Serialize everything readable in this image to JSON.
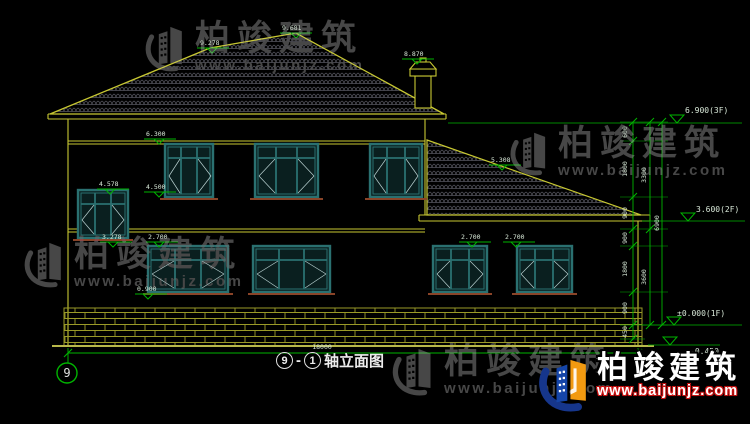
{
  "brand": {
    "name": "柏竣建筑",
    "url": "www.baijunjz.com"
  },
  "title_block": {
    "axis_left": "9",
    "separator": "-",
    "axis_right": "1",
    "name": "轴立面图"
  },
  "axis_bubbles": {
    "left": "9"
  },
  "dimensions": {
    "overall_width": "18000",
    "right_chain": [
      "600",
      "1800",
      "900",
      "900",
      "1800",
      "900",
      "450"
    ],
    "right_groups": [
      "3300",
      "3600"
    ],
    "right_total": "6900"
  },
  "level_marks": {
    "ridge_left": "9.278",
    "ridge_peak": "9.681",
    "chimney": "8.870",
    "win2_head": "6.300",
    "annex_ridge": "5.308",
    "stair_head": "4.578",
    "win2_sill": "4.500",
    "stair_sill": "3.278",
    "win1_head": "2.700",
    "annex_win1": "2.700",
    "annex_win2": "2.700",
    "win1_sill": "0.900",
    "floor3": "6.900(3F)",
    "floor2": "3.600(2F)",
    "floor1": "±0.000(1F)",
    "ground": "-0.450"
  },
  "colors": {
    "background": "#000000",
    "outline_yellow": "#c8c832",
    "dimension_green": "#00b400",
    "window_teal": "#2a7070",
    "tile_gray": "#55555e",
    "brick_olive": "#9a9a28",
    "sill_brown": "#8a4428",
    "label_text": "#d8e8d8",
    "watermark_gray": "#474747",
    "logo_blue": "#1545a8",
    "logo_orange": "#f29a10",
    "url_red": "#cc1111"
  }
}
